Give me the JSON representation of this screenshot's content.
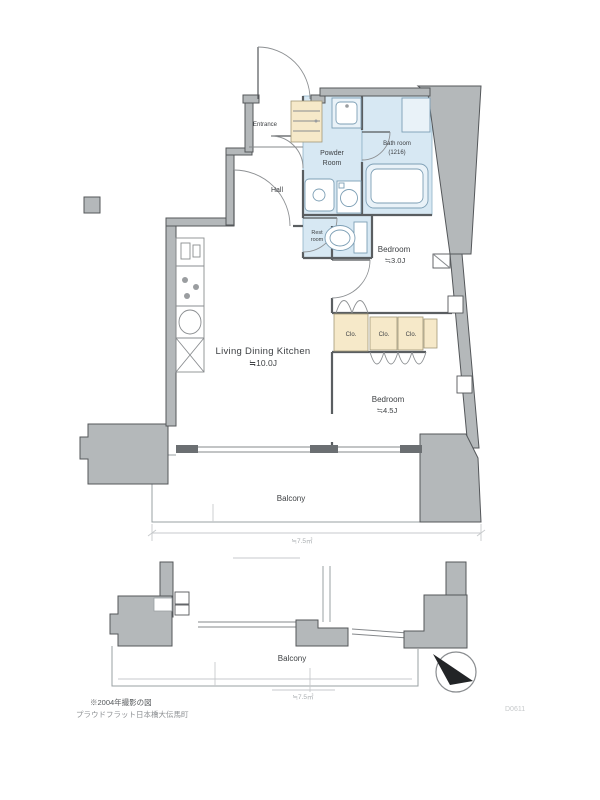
{
  "document": {
    "type": "floor-plan"
  },
  "rooms": {
    "entrance": "Entrance",
    "hall": "Hall",
    "powder_line1": "Powder",
    "powder_line2": "Room",
    "bath_line1": "Bath room",
    "bath_line2": "(1216)",
    "rest_line1": "Rest",
    "rest_line2": "room",
    "bedroom_small": "Bedroom",
    "bedroom_small_size": "≒3.0J",
    "ldk": "Living Dining Kitchen",
    "ldk_size": "≒10.0J",
    "bedroom_large": "Bedroom",
    "bedroom_large_size": "≒4.5J",
    "closet1": "Clo.",
    "closet2": "Clo.",
    "closet3": "Clo."
  },
  "balcony": {
    "upper_label": "Balcony",
    "upper_dim": "≒7.5㎡",
    "lower_label": "Balcony",
    "lower_dim": "≒7.5㎡"
  },
  "footer": {
    "note1": "※2004年撮影の図",
    "note2": "プラウドフラット日本橋大伝馬町",
    "doc_id": "D0611"
  },
  "colors": {
    "wall_gray": "#b4b8ba",
    "wet_blue": "#d7e8f3",
    "closet_beige": "#f6e9c9",
    "line_dark": "#54575a"
  }
}
